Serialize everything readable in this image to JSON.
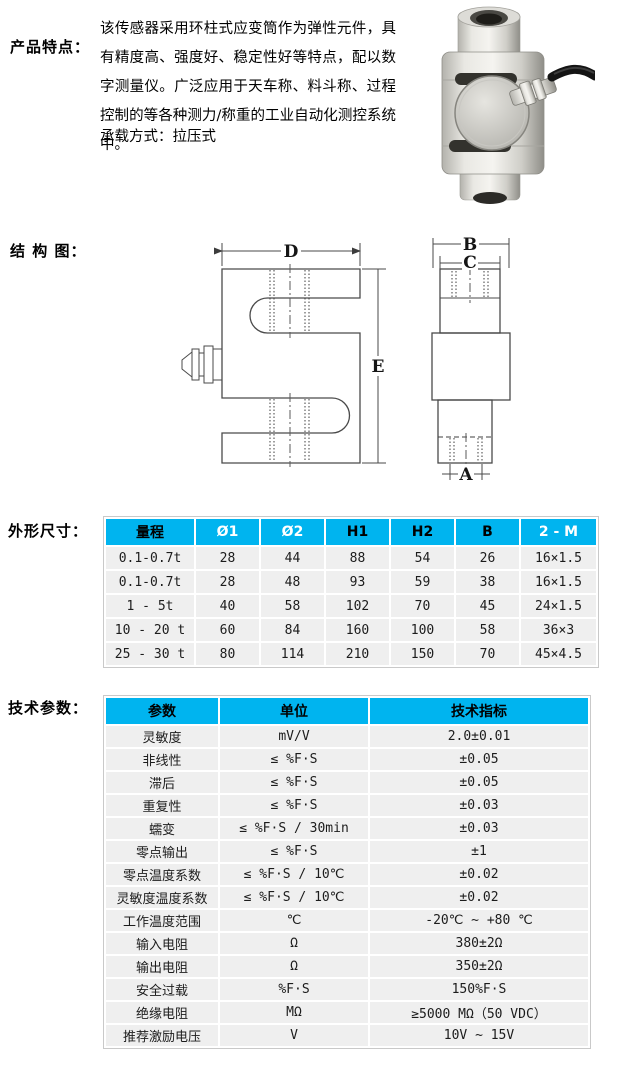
{
  "colors": {
    "page_bg": "#ffffff",
    "table_header_bg": "#00b4ef",
    "table_row_bg": "#efefef",
    "table_border": "#c9c9c9",
    "text": "#111111"
  },
  "features": {
    "label": "产品特点：",
    "description": "该传感器采用环柱式应变筒作为弹性元件，具有精度高、强度好、稳定性好等特点，配以数字测量仪。广泛应用于天车称、料斗称、过程控制的等各种测力/称重的工业自动化测控系统中。",
    "load_mode": "承载方式：拉压式",
    "photo": "s-type-column-load-cell-photo"
  },
  "structure": {
    "label": "结 构 图：",
    "dim_labels": {
      "D": "D",
      "E": "E",
      "B": "B",
      "C": "C",
      "A": "A"
    }
  },
  "dimensions": {
    "label": "外形尺寸：",
    "table": {
      "headers": [
        "量程",
        "Ø1",
        "Ø2",
        "H1",
        "H2",
        "B",
        "2 - M"
      ],
      "header_text_colors": [
        "#000000",
        "#ffffff",
        "#ffffff",
        "#000000",
        "#000000",
        "#000000",
        "#ffffff"
      ],
      "rows": [
        [
          "0.1-0.7t",
          "28",
          "44",
          "88",
          "54",
          "26",
          "16×1.5"
        ],
        [
          "0.1-0.7t",
          "28",
          "48",
          "93",
          "59",
          "38",
          "16×1.5"
        ],
        [
          "1 - 5t",
          "40",
          "58",
          "102",
          "70",
          "45",
          "24×1.5"
        ],
        [
          "10 - 20 t",
          "60",
          "84",
          "160",
          "100",
          "58",
          "36×3"
        ],
        [
          "25 - 30 t",
          "80",
          "114",
          "210",
          "150",
          "70",
          "45×4.5"
        ]
      ]
    }
  },
  "parameters": {
    "label": "技术参数：",
    "table": {
      "headers": [
        "参数",
        "单位",
        "技术指标"
      ],
      "header_text_colors": [
        "#000000",
        "#000000",
        "#000000"
      ],
      "rows": [
        [
          "灵敏度",
          "mV/V",
          "2.0±0.01"
        ],
        [
          "非线性",
          "≤ %F·S",
          "±0.05"
        ],
        [
          "滞后",
          "≤ %F·S",
          "±0.05"
        ],
        [
          "重复性",
          "≤ %F·S",
          "±0.03"
        ],
        [
          "蠕变",
          "≤ %F·S / 30min",
          "±0.03"
        ],
        [
          "零点输出",
          "≤ %F·S",
          "±1"
        ],
        [
          "零点温度系数",
          "≤ %F·S / 10℃",
          "±0.02"
        ],
        [
          "灵敏度温度系数",
          "≤ %F·S / 10℃",
          "±0.02"
        ],
        [
          "工作温度范围",
          "℃",
          "-20℃ ~ +80 ℃"
        ],
        [
          "输入电阻",
          "Ω",
          "380±2Ω"
        ],
        [
          "输出电阻",
          "Ω",
          "350±2Ω"
        ],
        [
          "安全过载",
          "%F·S",
          "150%F·S"
        ],
        [
          "绝缘电阻",
          "MΩ",
          "≥5000 MΩ（50 VDC）"
        ],
        [
          "推荐激励电压",
          "V",
          "10V ~ 15V"
        ]
      ]
    }
  }
}
